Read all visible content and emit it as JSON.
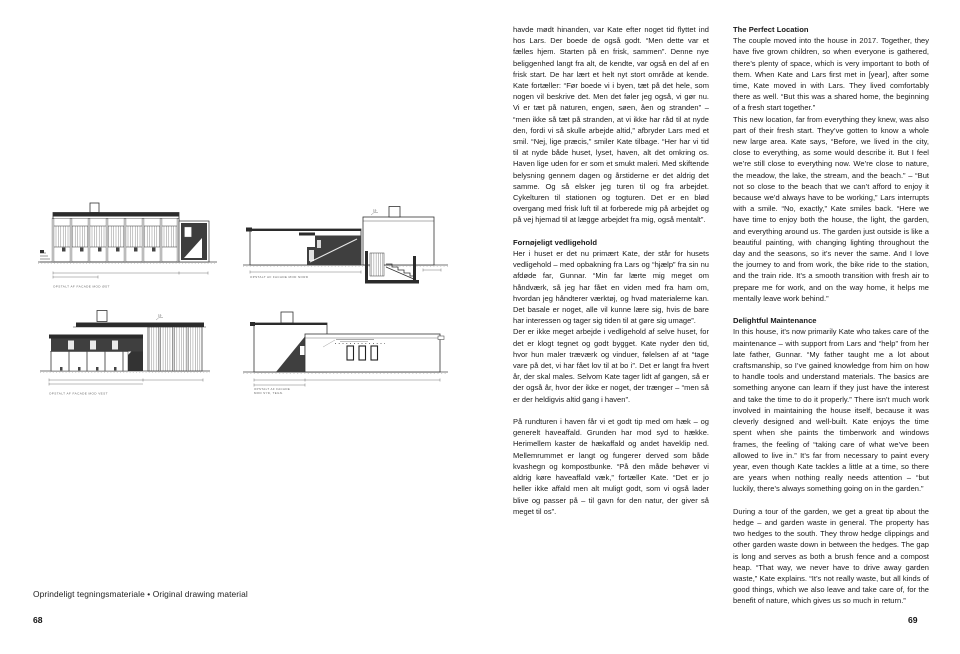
{
  "left_page": {
    "plate_caption": "Oprindeligt tegningsmateriale • Original drawing material",
    "page_number": "68",
    "drawings": {
      "level_mark": "19",
      "caption_a": "OPSTALT AF FACADE MOD ØST",
      "caption_b": "OPSTALT AF FACADE MOD NORD",
      "caption_c": "OPSTALT AF FACADE MOD VEST",
      "caption_d1": "OPSTALT AF FACADE",
      "caption_d2": "MOD SYD, TEGN."
    }
  },
  "right_page": {
    "page_number": "69",
    "danish": {
      "para1": "havde mødt hinanden, var Kate efter noget tid flyttet ind hos Lars. Der boede de også godt. “Men dette var et fælles hjem. Starten på en frisk, sammen”. Denne nye beliggenhed langt fra alt, de kendte, var også en del af en frisk start. De har lært et helt nyt stort område at kende. Kate fortæller: “Før boede vi i byen, tæt på det hele, som nogen vil beskrive det. Men det føler jeg også, vi gør nu. Vi er tæt på naturen, engen, søen, åen og stranden” – “men ikke så tæt på stranden, at vi ikke har råd til at nyde den, fordi vi så skulle arbejde altid,” afbryder Lars med et smil. “Nej, lige præcis,” smiler Kate tilbage. “Her har vi tid til at nyde både huset, lyset, haven, alt det omkring os. Haven lige uden for er som et smukt maleri. Med skiftende belysning gennem dagen og årstiderne er det aldrig det samme. Og så elsker jeg turen til og fra arbejdet. Cykelturen til stationen og togturen. Det er en blød overgang med frisk luft til at forberede mig på arbejdet og på vej hjemad til at lægge arbejdet fra mig, også mentalt”.",
      "heading1": "Fornøjeligt vedligehold",
      "para2": "Her i huset er det nu primært Kate, der står for husets vedligehold – med opbakning fra Lars og “hjælp” fra sin nu afdøde far, Gunnar. “Min far lærte mig meget om håndværk, så jeg har fået en viden med fra ham om, hvordan jeg håndterer værktøj, og hvad materialerne kan. Det basale er noget, alle vil kunne lære sig, hvis de bare har interessen og tager sig tiden til at gøre sig umage”.",
      "para3": "Der er ikke meget arbejde i vedligehold af selve huset, for det er klogt tegnet og godt bygget. Kate nyder den tid, hvor hun maler træværk og vinduer, følelsen af at “tage vare på det, vi har fået lov til at bo i”. Det er langt fra hvert år, der skal males. Selvom Kate tager lidt af gangen, så er der også år, hvor der ikke er noget, der trænger – “men så er der heldigvis altid gang i haven”.",
      "para4": "På rundturen i haven får vi et godt tip med om hæk – og generelt haveaffald. Grunden har mod syd to hække. Herimellem kaster de hækaffald og andet haveklip ned. Mellemrummet er langt og fungerer derved som både kvashegn og kompostbunke. “På den måde behøver vi aldrig køre haveaffald væk,” fortæller Kate. “Det er jo heller ikke affald men alt muligt godt, som vi også lader blive og passer på – til gavn for den natur, der giver så meget til os”."
    },
    "english": {
      "heading1": "The Perfect Location",
      "para1": "The couple moved into the house in 2017. Together, they have five grown children, so when everyone is gathered, there’s plenty of space, which is very important to both of them. When Kate and Lars first met in [year], after some time, Kate moved in with Lars. They lived comfortably there as well. “But this was a shared home, the beginning of a fresh start together.”",
      "para2": "This new location, far from everything they knew, was also part of their fresh start. They’ve gotten to know a whole new large area. Kate says, “Before, we lived in the city, close to everything, as some would describe it. But I feel we’re still close to everything now. We’re close to nature, the meadow, the lake, the stream, and the beach.” – “But not so close to the beach that we can’t afford to enjoy it because we’d always have to be working,” Lars interrupts with a smile. “No, exactly,” Kate smiles back. “Here we have time to enjoy both the house, the light, the garden, and everything around us. The garden just outside is like a beautiful painting, with changing lighting throughout the day and the seasons, so it’s never the same. And I love the journey to and from work, the bike ride to the station, and the train ride. It’s a smooth transition with fresh air to prepare me for work, and on the way home, it helps me mentally leave work behind.”",
      "heading2": "Delightful Maintenance",
      "para3": "In this house, it’s now primarily Kate who takes care of the maintenance – with support from Lars and “help” from her late father, Gunnar. “My father taught me a lot about craftsmanship, so I’ve gained knowledge from him on how to handle tools and understand materials. The basics are something anyone can learn if they just have the interest and take the time to do it properly.” There isn’t much work involved in maintaining the house itself, because it was cleverly designed and well-built. Kate enjoys the time spent when she paints the timberwork and windows frames, the feeling of “taking care of what we’ve been allowed to live in.” It’s far from necessary to paint every year, even though Kate tackles a little at a time, so there are years when nothing really needs attention – “but luckily, there’s always something going on in the garden.”",
      "para4": "During a tour of the garden, we get a great tip about the hedge – and garden waste in general. The property has two hedges to the south. They throw hedge clippings and other garden waste down in between the hedges. The gap is long and serves as both a brush fence and a compost heap. “That way, we never have to drive away garden waste,” Kate explains. “It’s not really waste, but all kinds of good things, which we also leave and take care of, for the benefit of nature, which gives us so much in return.”"
    }
  }
}
